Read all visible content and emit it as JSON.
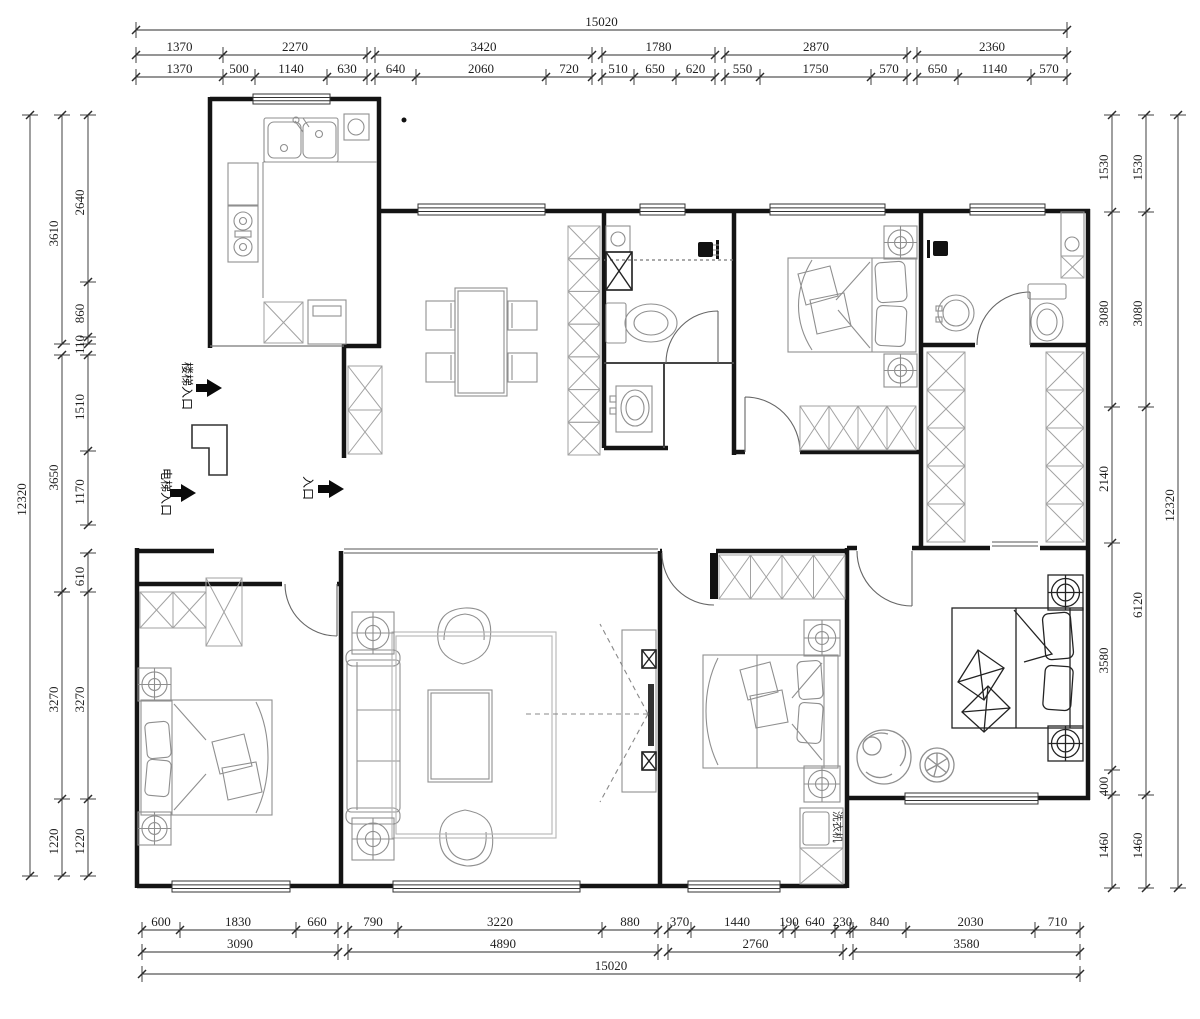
{
  "drawing": {
    "type": "residential floor plan",
    "units": "mm"
  },
  "labels": {
    "stairs_entrance": "楼梯入口",
    "elevator_entrance": "电梯入口",
    "entrance": "入口",
    "washing_machine": "洗衣机"
  },
  "dimensions": {
    "top": {
      "total": "15020",
      "row2": [
        "1370",
        "2270",
        "3420",
        "1780",
        "2870",
        "2360"
      ],
      "row3": [
        "1370",
        "500",
        "1140",
        "630",
        "640",
        "2060",
        "720",
        "510",
        "650",
        "620",
        "550",
        "1750",
        "570",
        "650",
        "1140",
        "570"
      ]
    },
    "bottom": {
      "row1": [
        "600",
        "1830",
        "660",
        "790",
        "3220",
        "880",
        "370",
        "1440",
        "190",
        "640",
        "230",
        "840",
        "2030",
        "710"
      ],
      "row2": [
        "3090",
        "4890",
        "2760",
        "3580"
      ],
      "total": "15020"
    },
    "left": {
      "inner": [
        "2640",
        "860",
        "110",
        "1510",
        "1170",
        "610",
        "3270",
        "1220"
      ],
      "middle": [
        "3610",
        "3650",
        "3270",
        "1220"
      ],
      "total": "12320"
    },
    "right": {
      "inner": [
        "1530",
        "3080",
        "2140",
        "3580",
        "400",
        "1460"
      ],
      "outer": [
        "1530",
        "3080",
        "6120",
        "1460"
      ],
      "total": "12320"
    }
  },
  "colors": {
    "wall": "#141414",
    "furniture": "#8f8f8f",
    "cabinet": "#a2a2a2",
    "dimension": "#1f1f1f",
    "background": "#ffffff"
  }
}
